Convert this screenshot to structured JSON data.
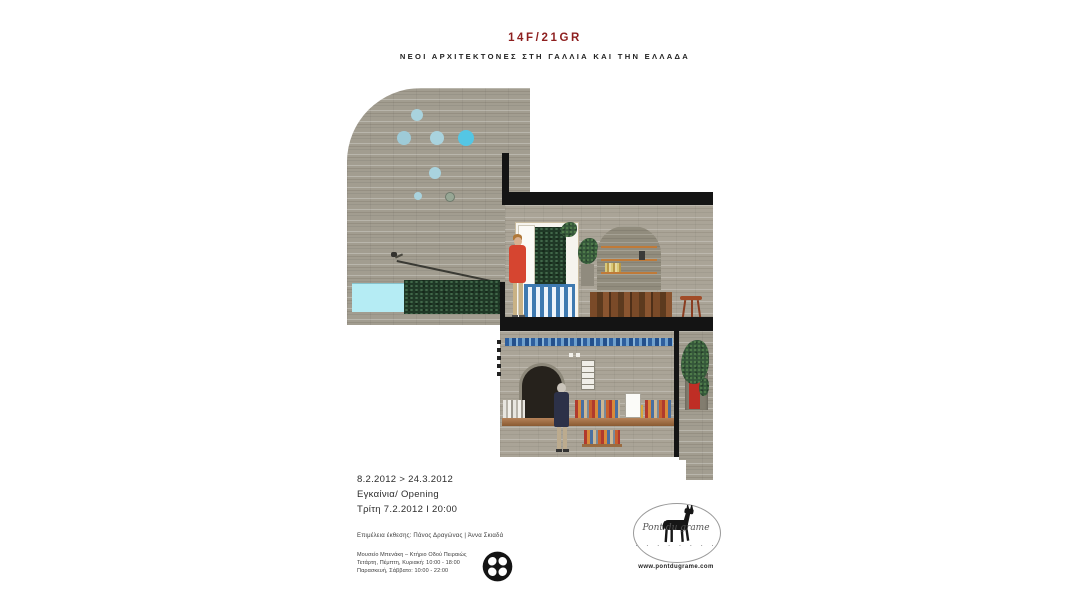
{
  "poster": {
    "title": "14F/21GR",
    "subtitle": "ΝΕΟΙ ΑΡΧΙΤΕΚΤΟΝΕΣ ΣΤΗ ΓΑΛΛΙΑ ΚΑΙ ΤΗΝ ΕΛΛΑΔΑ"
  },
  "event": {
    "dates": "8.2.2012 > 24.3.2012",
    "opening": "Εγκαίνια/ Opening",
    "opening_time": "Τρίτη 7.2.2012 Ι 20:00",
    "curators": "Επιμέλεια έκθεσης: Πάνος Δραγώνας | Άννα Σκιαδά",
    "venue": "Μουσείο Μπενάκη – Κτήριο Οδού Πειραιώς",
    "hours_line1": "Τετάρτη, Πέμπτη, Κυριακή: 10:00 - 18:00",
    "hours_line2": "Παρασκευή, Σάββατο: 10:00 - 22:00"
  },
  "partner_logo": {
    "script_text": "Pont du grame",
    "dots": "· · · · · · · ·",
    "url": "www.pontdugrame.com"
  },
  "colors": {
    "title_red": "#8e1f1f",
    "wall_gray": "#a29d90",
    "skylight_cyan": "#54c6e4",
    "skylight_pale": "#a9d3de",
    "pool_cyan": "#b5ecf4",
    "gate_blue": "#3f7ab0",
    "jacket_red": "#d64530",
    "planter_red": "#bf2e25",
    "slab_black": "#141414"
  },
  "illustration_alt": "Architectural cross-section collage: two-level interior with round skylights, stair handrail, pool window with trees, figure in red coat by an open blue-slatted door, arched wall niches, wooden counter and stool, lower library level with blue tile band, bookshelves, figure in dark coat, and a red planter with climbing plant"
}
